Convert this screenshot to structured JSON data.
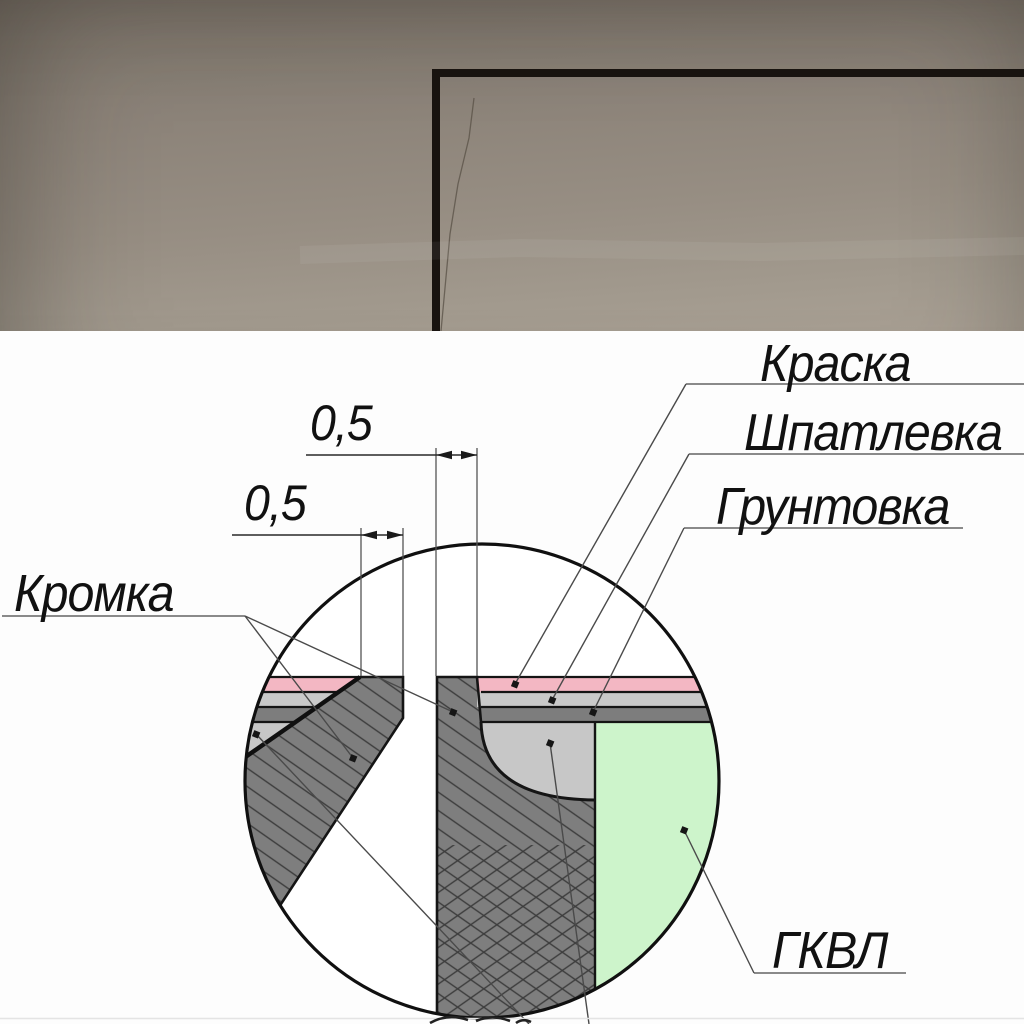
{
  "diagram": {
    "callouts": {
      "paint": "Краска",
      "filler": "Шпатлевка",
      "primer": "Грунтовка",
      "edge": "Кромка",
      "board": "ГКВЛ"
    },
    "dimensions": {
      "top_gap": "0,5",
      "left_gap": "0,5"
    }
  },
  "theme": {
    "c-pink": "#f3b7c3",
    "c-bandlight": "#c9c9c9",
    "c-banddark": "#7d7d7d",
    "c-putty": "#c7c7c7",
    "c-green": "#cdf4cb",
    "c-board": "#7e7e7e",
    "c-line": "#141414",
    "c-leader": "#4a4a4a",
    "c-underline": "#7a7a7a",
    "c-photo-top": "#7f766c",
    "c-photo-mid": "#978e83",
    "c-photo-bot": "#aaa195"
  }
}
